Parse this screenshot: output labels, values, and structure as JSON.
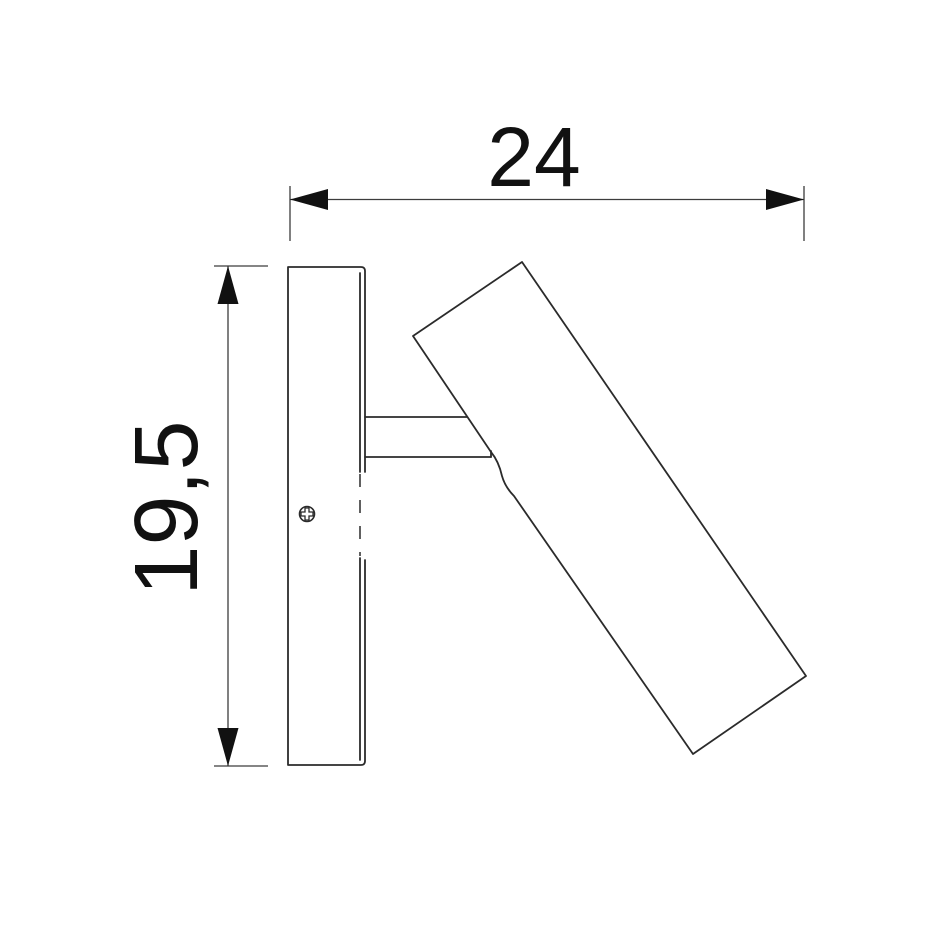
{
  "colors": {
    "background": "#ffffff",
    "object_line": "#2b2b2b",
    "dimension_line": "#3c3c3c",
    "arrow": "#111111",
    "text": "#111111"
  },
  "dimensions": {
    "width": {
      "label": "24"
    },
    "height": {
      "label": "19,5"
    }
  }
}
